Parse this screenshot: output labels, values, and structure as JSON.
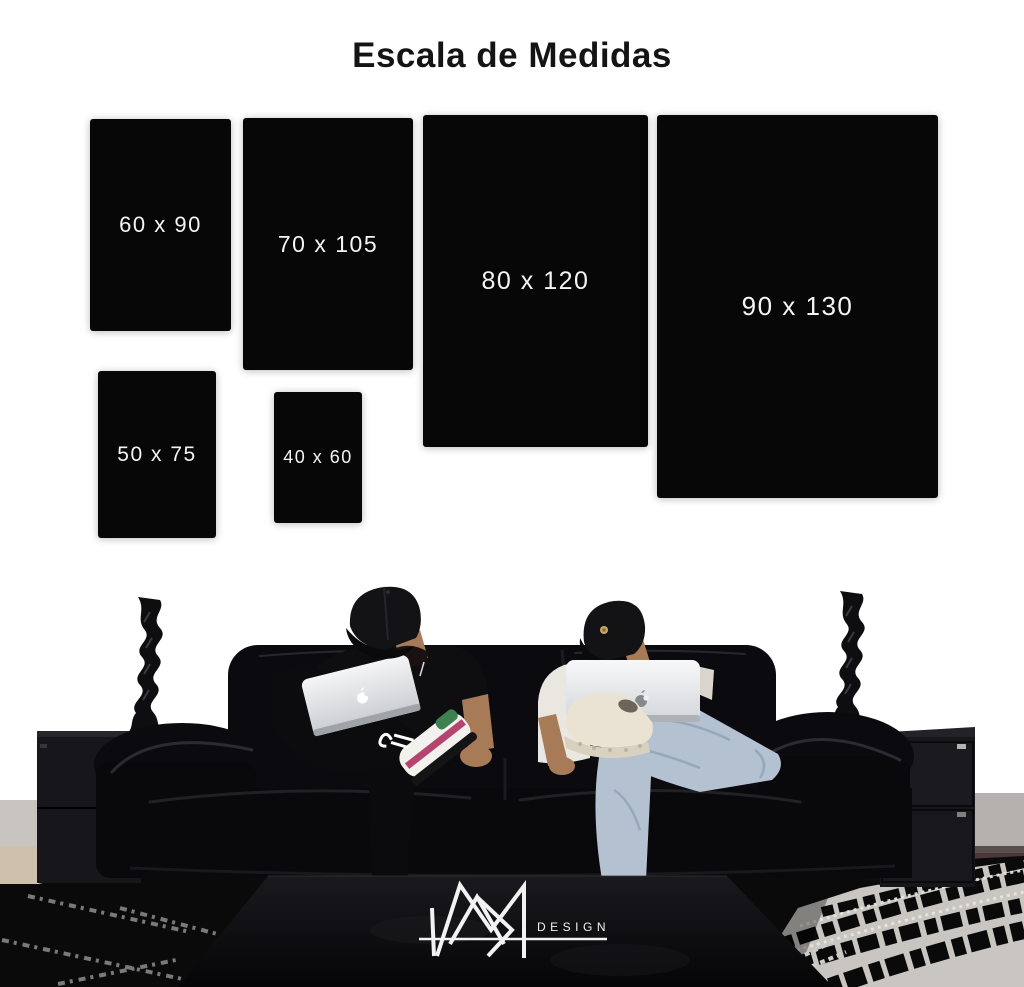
{
  "title": "Escala de Medidas",
  "scale_boxes": [
    {
      "label": "60 x 90",
      "width_cm": 60,
      "height_cm": 90,
      "box": {
        "left": 90,
        "top": 119,
        "width": 141,
        "height": 212,
        "font_size": 22
      }
    },
    {
      "label": "70 x 105",
      "width_cm": 70,
      "height_cm": 105,
      "box": {
        "left": 243,
        "top": 118,
        "width": 170,
        "height": 252,
        "font_size": 23
      }
    },
    {
      "label": "80 x 120",
      "width_cm": 80,
      "height_cm": 120,
      "box": {
        "left": 423,
        "top": 115,
        "width": 225,
        "height": 332,
        "font_size": 25
      }
    },
    {
      "label": "90 x 130",
      "width_cm": 90,
      "height_cm": 130,
      "box": {
        "left": 657,
        "top": 115,
        "width": 281,
        "height": 383,
        "font_size": 26
      }
    },
    {
      "label": "50 x 75",
      "width_cm": 50,
      "height_cm": 75,
      "box": {
        "left": 98,
        "top": 371,
        "width": 118,
        "height": 167,
        "font_size": 21
      }
    },
    {
      "label": "40 x 60",
      "width_cm": 40,
      "height_cm": 60,
      "box": {
        "left": 274,
        "top": 392,
        "width": 88,
        "height": 131,
        "font_size": 18
      }
    }
  ],
  "brand": {
    "name": "DESIGN",
    "monogram": "MR"
  },
  "scene": {
    "alt": "Two men in black caps sit on a black leather sofa using Apple laptops, flanked by twisted black candlesticks on dark cabinets, a black coffee table with the MR Design logo, and a black-and-white striped shag rug."
  },
  "colors": {
    "background": "#ffffff",
    "panel_black": "#070708",
    "label_text": "#f5f5f5",
    "title_text": "#141414",
    "couch": "#0b0b0f",
    "couch_highlight": "#33333b",
    "seat_dark": "#09090c",
    "cap": "#131316",
    "skin": "#a87b58",
    "tee_white": "#eae7e1",
    "jeans": "#b4c1d0",
    "jeans_shadow": "#8fa2b6",
    "laptop_silver": "#eceeef",
    "laptop_shade": "#c3c7cb",
    "sneaker_pink": "#b5456f",
    "sneaker_green": "#3e8050",
    "sneaker_cream": "#eae3d3",
    "cabinet": "#17171b",
    "sculpture": "#0e0e11",
    "baseboard": "#b5b1ae",
    "floor_left": "#cfc0ab",
    "floor_right": "#4a363c",
    "rug_black": "#0a0a0a",
    "rug_white": "#c9c6c1",
    "table": "#0d0d10",
    "logo_white": "#f2f2f2",
    "cap_badge_gold": "#c9a86a"
  }
}
